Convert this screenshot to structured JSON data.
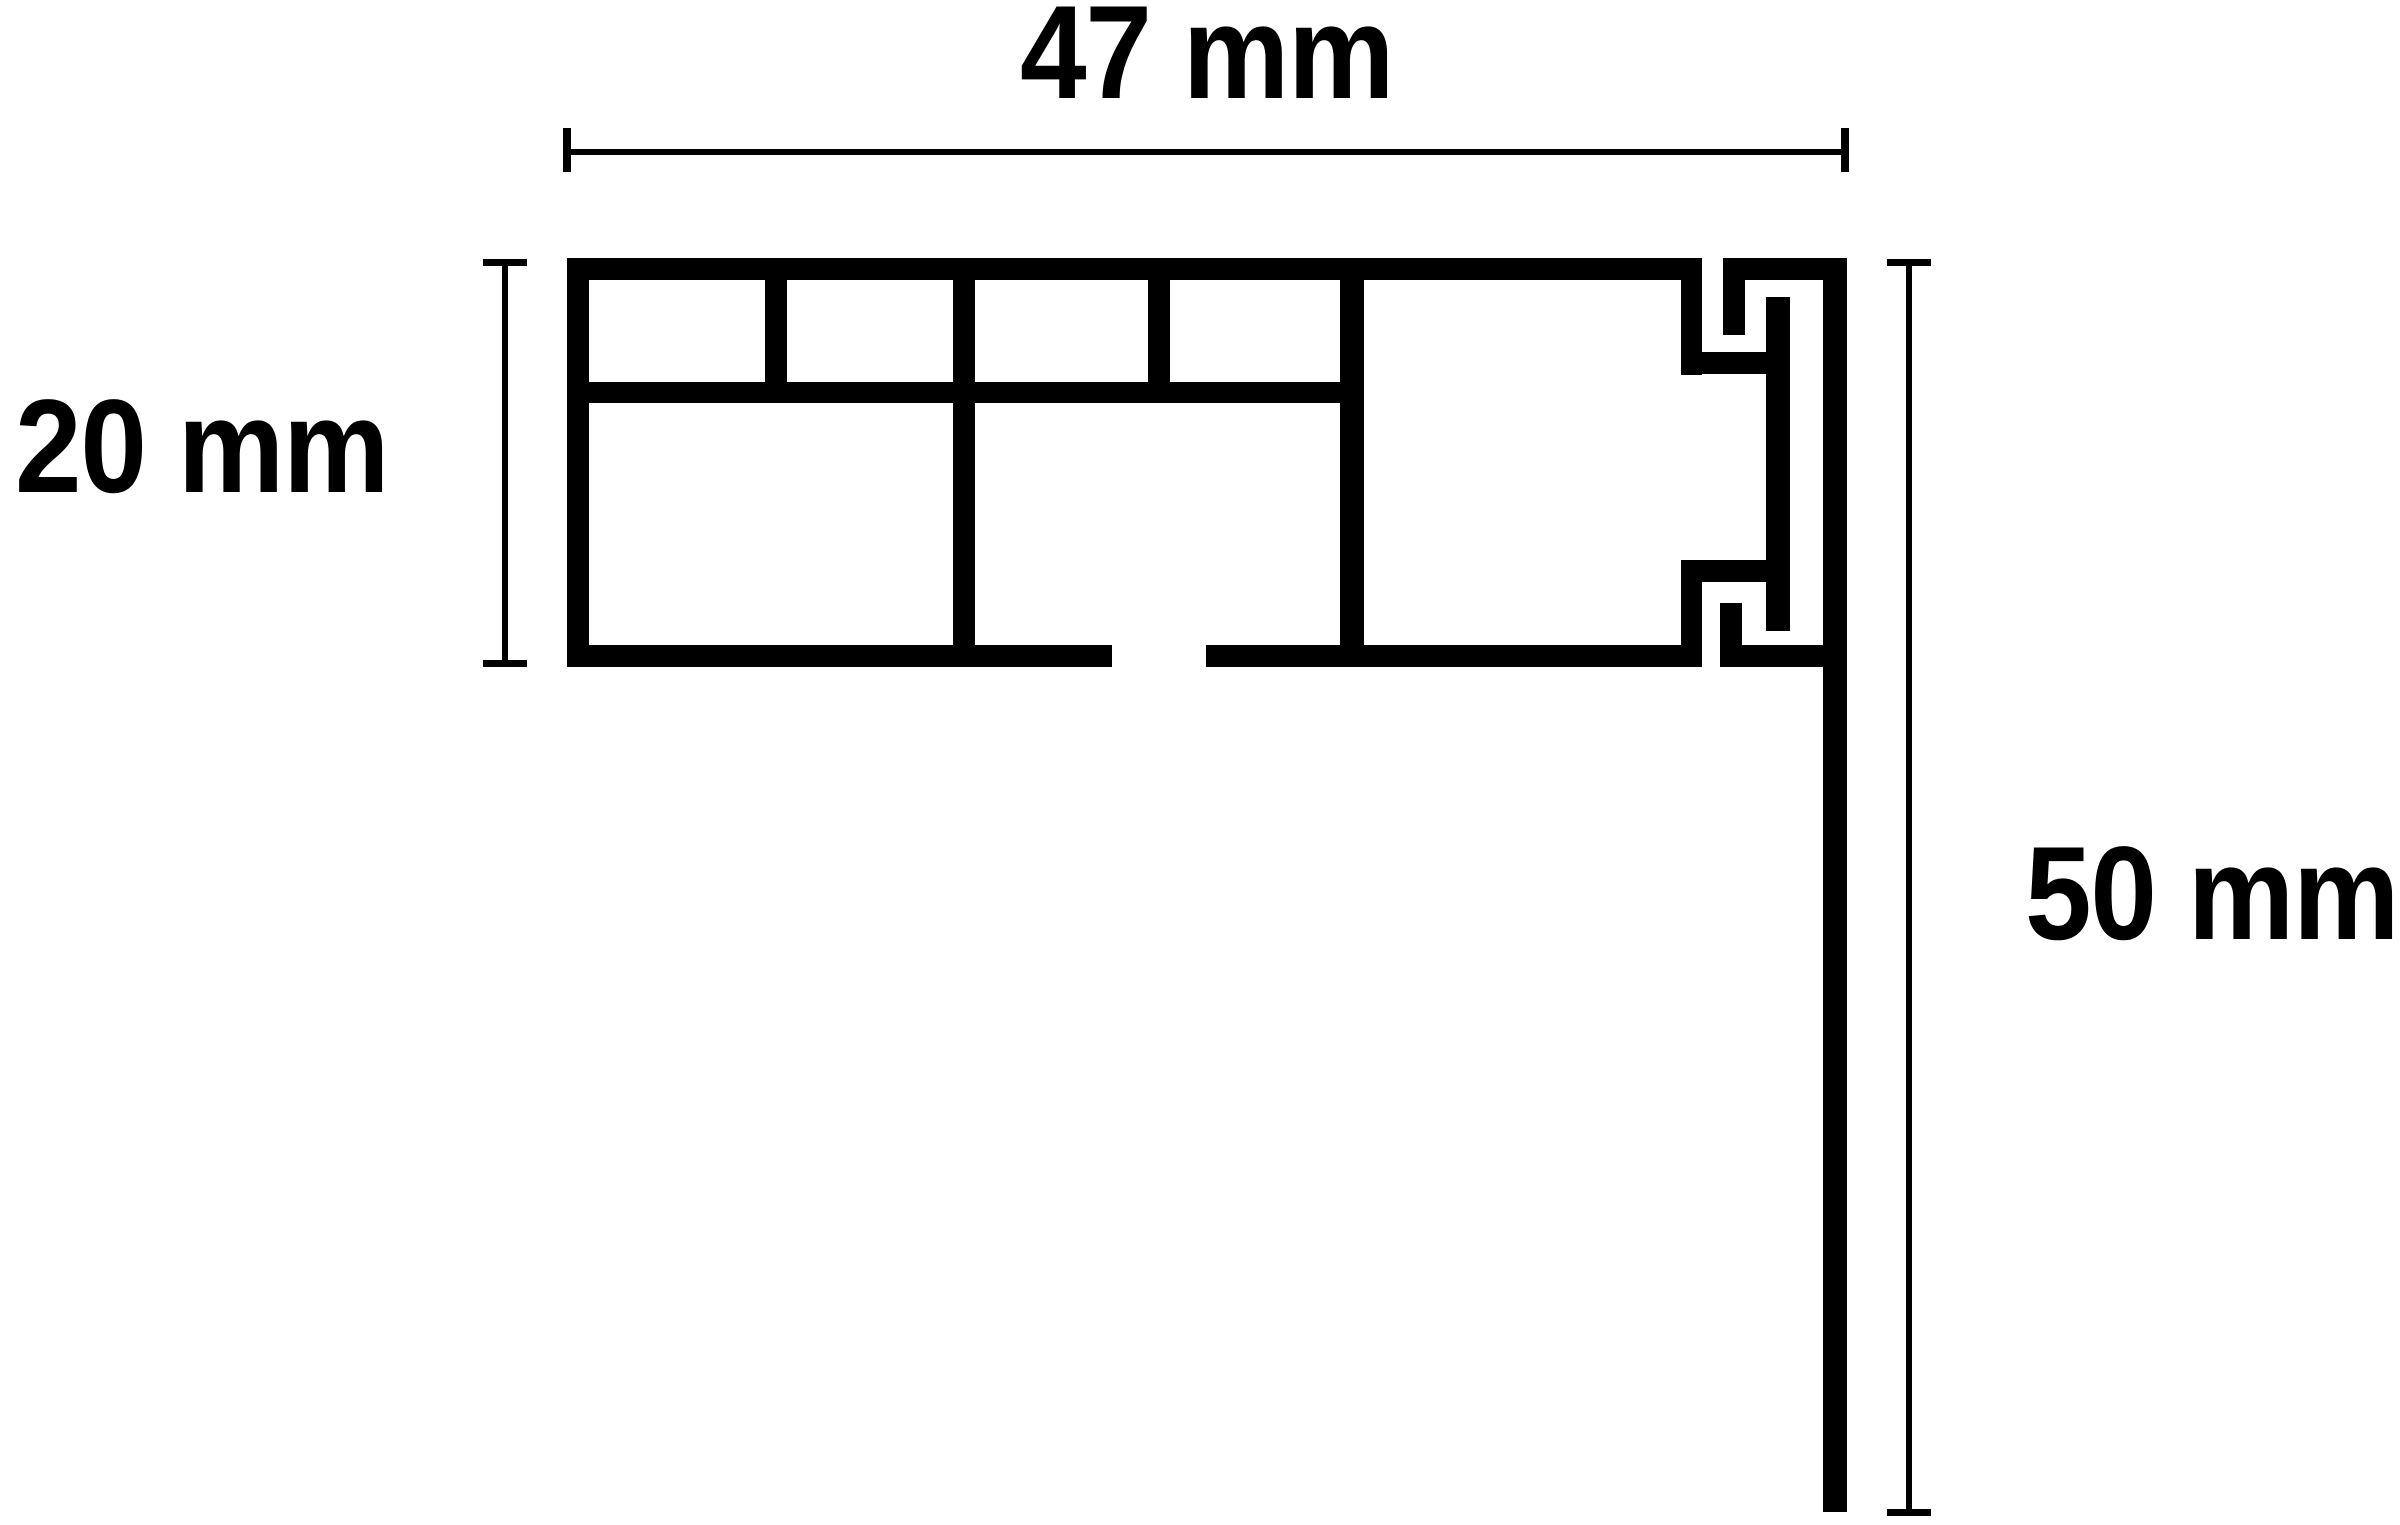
{
  "diagram": {
    "kind": "profile-cross-section-dimension-drawing",
    "unit": "mm",
    "dimensions": {
      "width": {
        "value": 47,
        "unit": "mm",
        "label": "47 mm"
      },
      "height": {
        "value": 20,
        "unit": "mm",
        "label": "20 mm"
      },
      "drop": {
        "value": 50,
        "unit": "mm",
        "label": "50 mm"
      }
    },
    "colors": {
      "ink": "#000000",
      "background": "#ffffff"
    }
  }
}
